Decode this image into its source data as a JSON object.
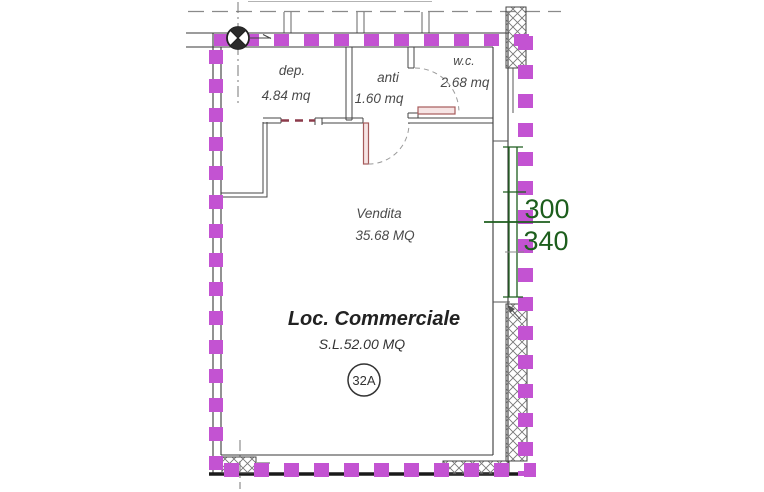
{
  "rooms": {
    "dep": {
      "label": "dep.",
      "area": "4.84 mq"
    },
    "anti": {
      "label": "anti",
      "area": "1.60 mq"
    },
    "wc": {
      "label": "w.c.",
      "area": "2.68 mq"
    },
    "vendita": {
      "label": "Vendita",
      "area": "35.68 MQ"
    }
  },
  "unit": {
    "name": "Loc. Commerciale",
    "surface_label": "S.L.52.00 MQ",
    "plan_number": "32A"
  },
  "window_dims": {
    "width_cm": "300",
    "height_cm": "340"
  },
  "colors": {
    "highlight": "#c353d2",
    "dimension": "#1d5e1d",
    "door": "#a65b5b",
    "opening_dashed": "#8c3a4a",
    "wall": "#3a3a3a"
  }
}
